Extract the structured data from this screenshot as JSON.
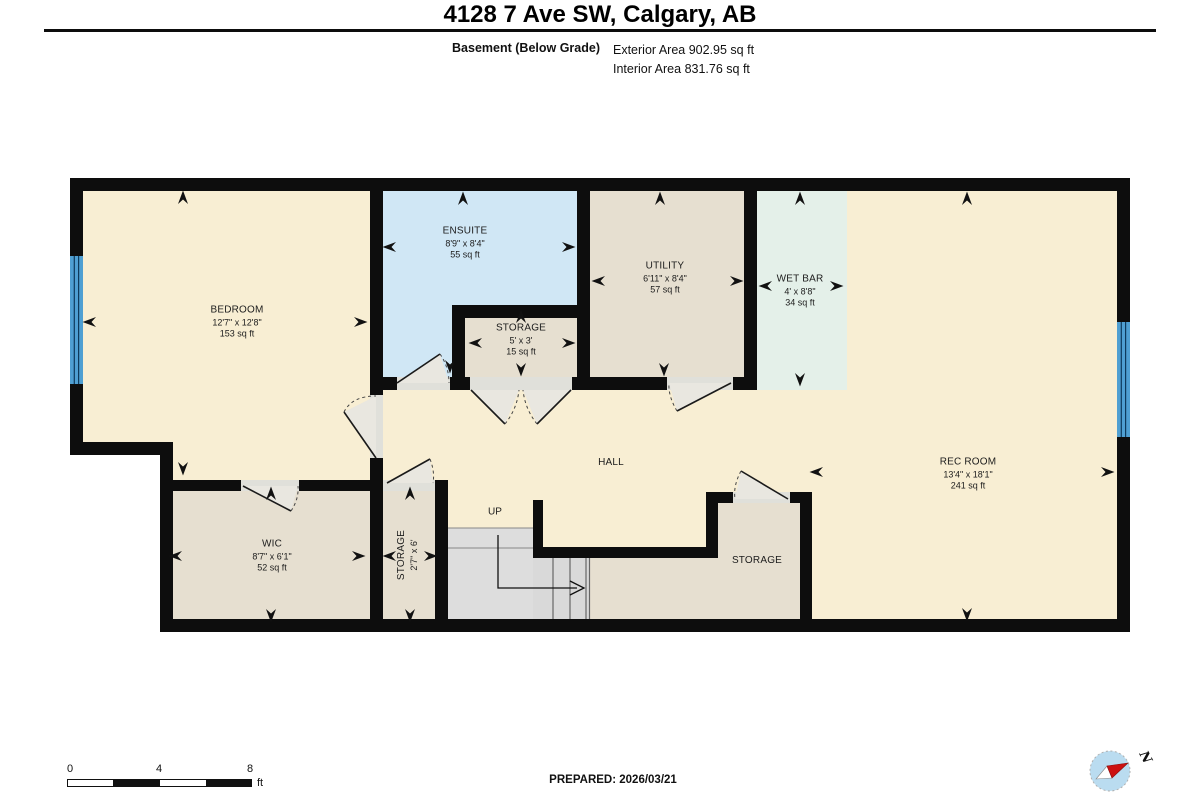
{
  "header": {
    "title": "4128 7 Ave SW, Calgary, AB",
    "floor_label": "Basement (Below Grade)",
    "exterior_area": "Exterior Area 902.95 sq ft",
    "interior_area": "Interior Area 831.76 sq ft"
  },
  "rooms": [
    {
      "name": "BEDROOM",
      "dims": "12'7\" x 12'8\"",
      "area": "153 sq ft"
    },
    {
      "name": "ENSUITE",
      "dims": "8'9\" x 8'4\"",
      "area": "55 sq ft"
    },
    {
      "name": "STORAGE",
      "dims": "5' x 3'",
      "area": "15 sq ft"
    },
    {
      "name": "UTILITY",
      "dims": "6'11\" x 8'4\"",
      "area": "57 sq ft"
    },
    {
      "name": "WET BAR",
      "dims": "4' x 8'8\"",
      "area": "34 sq ft"
    },
    {
      "name": "REC ROOM",
      "dims": "13'4\" x 18'1\"",
      "area": "241 sq ft"
    },
    {
      "name": "HALL"
    },
    {
      "name": "WIC",
      "dims": "8'7\" x 6'1\"",
      "area": "52 sq ft"
    },
    {
      "name": "STORAGE",
      "dims": "2'7\" x 6'"
    },
    {
      "name": "STORAGE"
    }
  ],
  "stairs": {
    "label": "UP"
  },
  "footer": {
    "scale_ticks": [
      "0",
      "4",
      "8"
    ],
    "scale_unit": "ft",
    "prepared": "PREPARED: 2026/03/21",
    "compass_north": "N"
  },
  "colors": {
    "wall": "#0d0d0d",
    "floor_main": "#f8eed3",
    "floor_tan": "#e6dfd0",
    "floor_blue": "#d0e7f5",
    "floor_mint": "#e4f0e9",
    "stairs": "#dcdcdc",
    "window": "#4f9fd2"
  }
}
